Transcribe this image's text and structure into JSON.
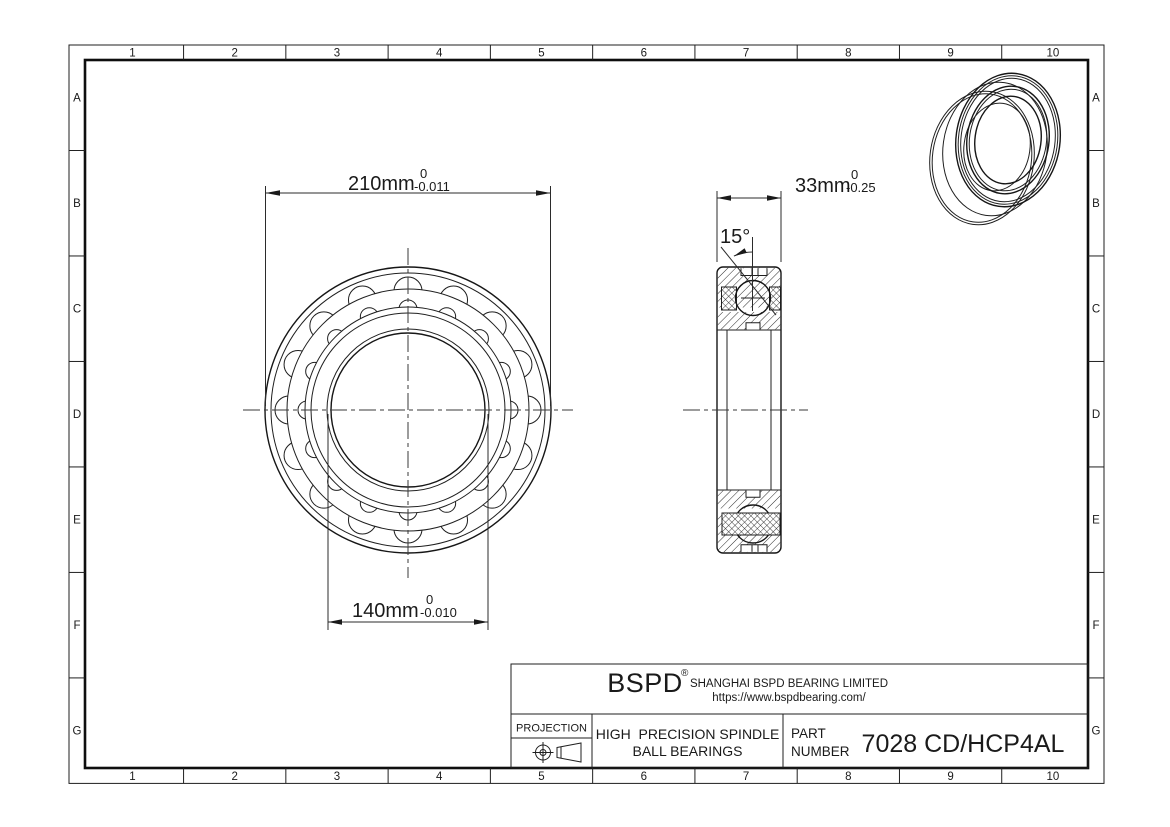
{
  "drawing": {
    "grid": {
      "columns": [
        "1",
        "2",
        "3",
        "4",
        "5",
        "6",
        "7",
        "8",
        "9",
        "10"
      ],
      "rows": [
        "A",
        "B",
        "C",
        "D",
        "E",
        "F",
        "G"
      ]
    },
    "dimensions": {
      "outer_diameter": {
        "value": "210mm",
        "tol_upper": "0",
        "tol_lower": "-0.011"
      },
      "bore_diameter": {
        "value": "140mm",
        "tol_upper": "0",
        "tol_lower": "-0.010"
      },
      "width": {
        "value": "33mm",
        "tol_upper": "0",
        "tol_lower": "-0.25"
      },
      "contact_angle": {
        "value": "15°"
      }
    },
    "title_block": {
      "logo": "BSPD",
      "logo_reg": "®",
      "company": "SHANGHAI BSPD BEARING LIMITED",
      "website": "https://www.bspdbearing.com/",
      "projection_label": "PROJECTION",
      "product_line1": "HIGH  PRECISION SPINDLE",
      "product_line2": "BALL BEARINGS",
      "part_label_line1": "PART",
      "part_label_line2": "NUMBER",
      "part_number": "7028 CD/HCP4AL"
    },
    "colors": {
      "line": "#1a1a1a",
      "background": "#ffffff"
    }
  }
}
